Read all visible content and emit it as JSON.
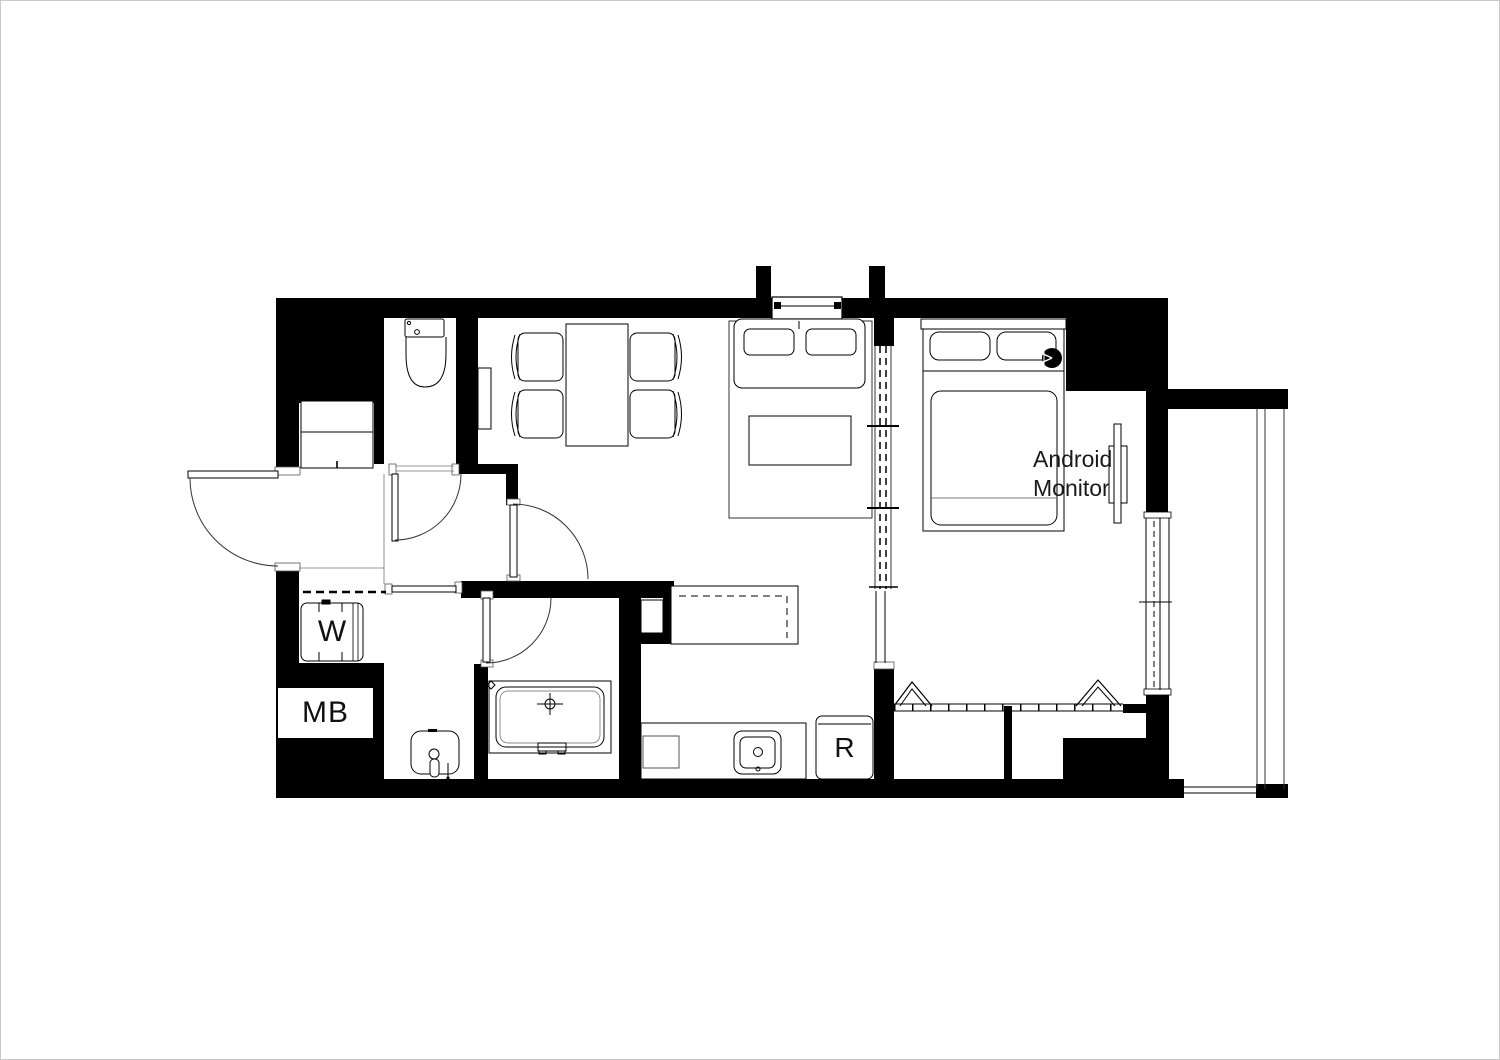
{
  "labels": {
    "washer": "W",
    "meter_box": "MB",
    "refrigerator": "R",
    "monitor_line1": "Android",
    "monitor_line2": "Monitor"
  },
  "colors": {
    "wall": "#000000",
    "background": "#ffffff",
    "line": "#000000",
    "thin_line": "#555555"
  }
}
